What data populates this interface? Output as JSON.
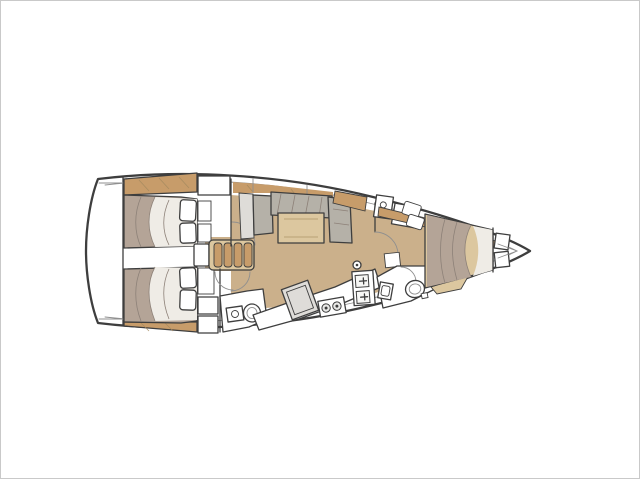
{
  "page": {
    "description": "Sailing yacht interior layout floor plan, bow pointing right, stern at left, drawn top-down on a white background"
  },
  "colors": {
    "white": "#ffffff",
    "outline": "#3e3e3e",
    "line": "#8f8f8f",
    "floor": "#cbb08b",
    "wood": "#c79c6a",
    "wood_light": "#dcc79f",
    "mattress": "#b4a497",
    "sheet": "#efece6",
    "cushion": "#b5b1a8",
    "panel": "#dedcd8",
    "grain": "#a4895f",
    "crease": "#8d8178",
    "hatch": "#6f6f6f",
    "steel": "#e9e9e7"
  },
  "vessel": {
    "type": "monohull-sailboat-floor-plan",
    "bow_side": "right",
    "stern_side": "left",
    "cabins": 3,
    "heads": 2
  },
  "rooms": {
    "transom": {
      "label": "stern transom locker area"
    },
    "aft_cabin_port": {
      "label": "aft port cabin",
      "furniture": "double bed, two pillows, hull shelf, hanging locker"
    },
    "aft_cabin_starboard": {
      "label": "aft starboard cabin",
      "furniture": "double bed, two pillows, hull shelf, lockers"
    },
    "companionway": {
      "label": "companionway stairs",
      "steps": 4
    },
    "aft_head": {
      "label": "aft head (bathroom)",
      "furniture": "toilet, washbasin"
    },
    "salon": {
      "label": "salon",
      "furniture": "U-shaped settee, dining table, sideboard, mast post"
    },
    "galley": {
      "label": "galley",
      "furniture": "fridge, two-burner stove, double sink, counter"
    },
    "forward_head": {
      "label": "forward head (bathroom)",
      "furniture": "toilet, washbasin"
    },
    "forward_cabin": {
      "label": "forward cabin",
      "furniture": "island double bed, bow shelves, seat cushions"
    }
  }
}
